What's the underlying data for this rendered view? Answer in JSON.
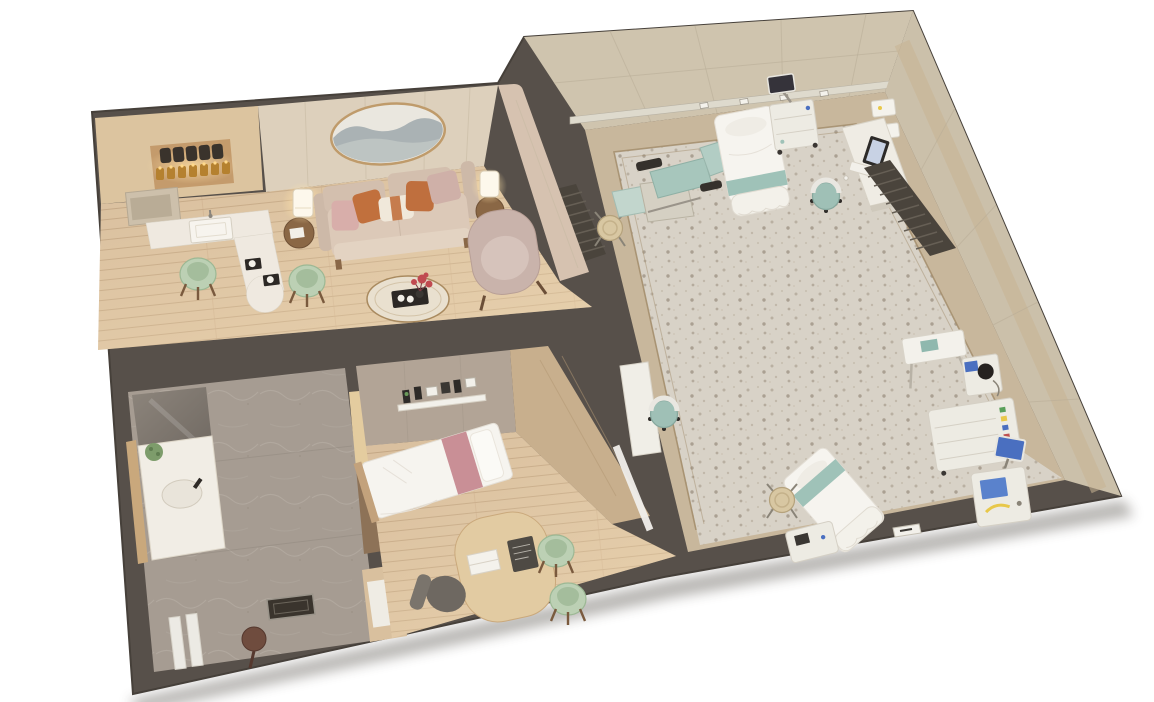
{
  "scene": {
    "type": "3d-floorplan-render",
    "view": "isometric top-down cutaway, tilted slightly counter-clockwise",
    "background": "#ffffff",
    "description": "Photorealistic 3D cutaway floor plan of a medical birthing/patient suite: a residential-style apartment (kitchenette with lit shelf jars, living room with sofa and oval mountain artwork, stone bathroom, exam bedroom with single bed and consult desk) adjoining a large clinical exam room with procedure chair, hospital beds, medical carts and monitors on a terrazzo floor"
  },
  "palette": {
    "wall": "#57504a",
    "wallEdge": "#46403a",
    "clinicWallFace": "#cfc4ae",
    "clinicWallFaceDark": "#cbc0aa",
    "rail": "#dedacd",
    "terrazzo": "#d8d2c7",
    "terrazzoSpeckle": "#b3aa9c",
    "walkway": "#c8b79c",
    "borderLine": "#a08a68",
    "woodFloor": "#d9bf9e",
    "woodPlank": "#c2a583",
    "stoneFloor": "#a69c92",
    "suiteWall": "#ddd0bc",
    "suiteWallPink": "#d6c2b0",
    "cabinet": "#dcc49f",
    "counter": "#efe9e0",
    "sage": "#bcd0b4",
    "sageDark": "#a4bd9c",
    "sofa": "#d3bfae",
    "pillowPink": "#d8aeaa",
    "pillowRust": "#c1703d",
    "pillowCream": "#f0e8da",
    "armchair": "#c9b3ab",
    "tableWood": "#8a6745",
    "lampGlow": "#ffe2a8",
    "artFrame": "#bf9b6b",
    "artMountain": "#9fa8ad",
    "bedWhite": "#f6f4ef",
    "bedPink": "#c98f96",
    "fabricWall": "#b2a496",
    "teal": "#9fc2b8",
    "tealLight": "#b2cdc4",
    "equipment": "#edebe3",
    "screenBlue": "#4a6fc0",
    "slats": "#4a443c",
    "deskWood": "#e2cba2",
    "chairGray": "#6e6861",
    "stool": "#d8c7a2",
    "plant": "#7d9c6b",
    "flowerRed": "#c04a50",
    "accentYellow": "#e8c84a"
  },
  "rooms": [
    {
      "id": "kitchenette",
      "floor": "wood",
      "items": [
        "wall-shelf-unit",
        "dark-jars-row",
        "lit-amber-jars-row",
        "microwave",
        "l-shaped-counter",
        "sink",
        "service-tray",
        "service-tray",
        "sage-chair",
        "sage-chair",
        "side-table",
        "table-lamp",
        "curved-partition"
      ]
    },
    {
      "id": "living-room",
      "floor": "wood",
      "items": [
        "oval-landscape-art",
        "three-seat-sofa",
        "throw-pillows-x5",
        "side-table-left",
        "table-lamp-left",
        "side-table-right",
        "table-lamp-right",
        "wingback-armchair",
        "round-coffee-table",
        "decor-tray",
        "red-flower-vase"
      ]
    },
    {
      "id": "bathroom",
      "floor": "stone",
      "items": [
        "mirror-panel",
        "vanity-counter",
        "oval-sink",
        "plant",
        "wood-ledge",
        "shower-drain",
        "shower-stool",
        "glass-partition"
      ]
    },
    {
      "id": "exam-bedroom",
      "floor": "wood",
      "items": [
        "single-bed",
        "pink-bed-runner",
        "wall-diagnostic-panel",
        "consult-desk",
        "laptop",
        "dark-tablet",
        "office-chair",
        "sage-chair",
        "sage-chair",
        "wardrobe-niche",
        "glass-door"
      ]
    },
    {
      "id": "clinical-room",
      "floor": "terrazzo",
      "items": [
        "procedure-chair",
        "hospital-bed-top",
        "equipment-cart-with-monitor",
        "workstation-desk",
        "desktop-monitor",
        "keyboard",
        "task-chair",
        "slatted-screen-corner",
        "slatted-screen-desk",
        "wall-rail-with-outlets",
        "wall-cabinets",
        "side-console",
        "task-chair-2",
        "round-stool",
        "round-stool-2",
        "overbed-table",
        "examination-scope",
        "supply-cart",
        "patient-monitor",
        "medical-device-with-screen",
        "hospital-bed-bottom",
        "bedside-machine",
        "floor-sign"
      ]
    }
  ],
  "counts": {
    "hospital_beds": 2,
    "procedure_chairs": 1,
    "single_beds": 1,
    "sage_chairs": 4,
    "task_chairs": 2,
    "stools": 2,
    "table_lamps": 3
  }
}
